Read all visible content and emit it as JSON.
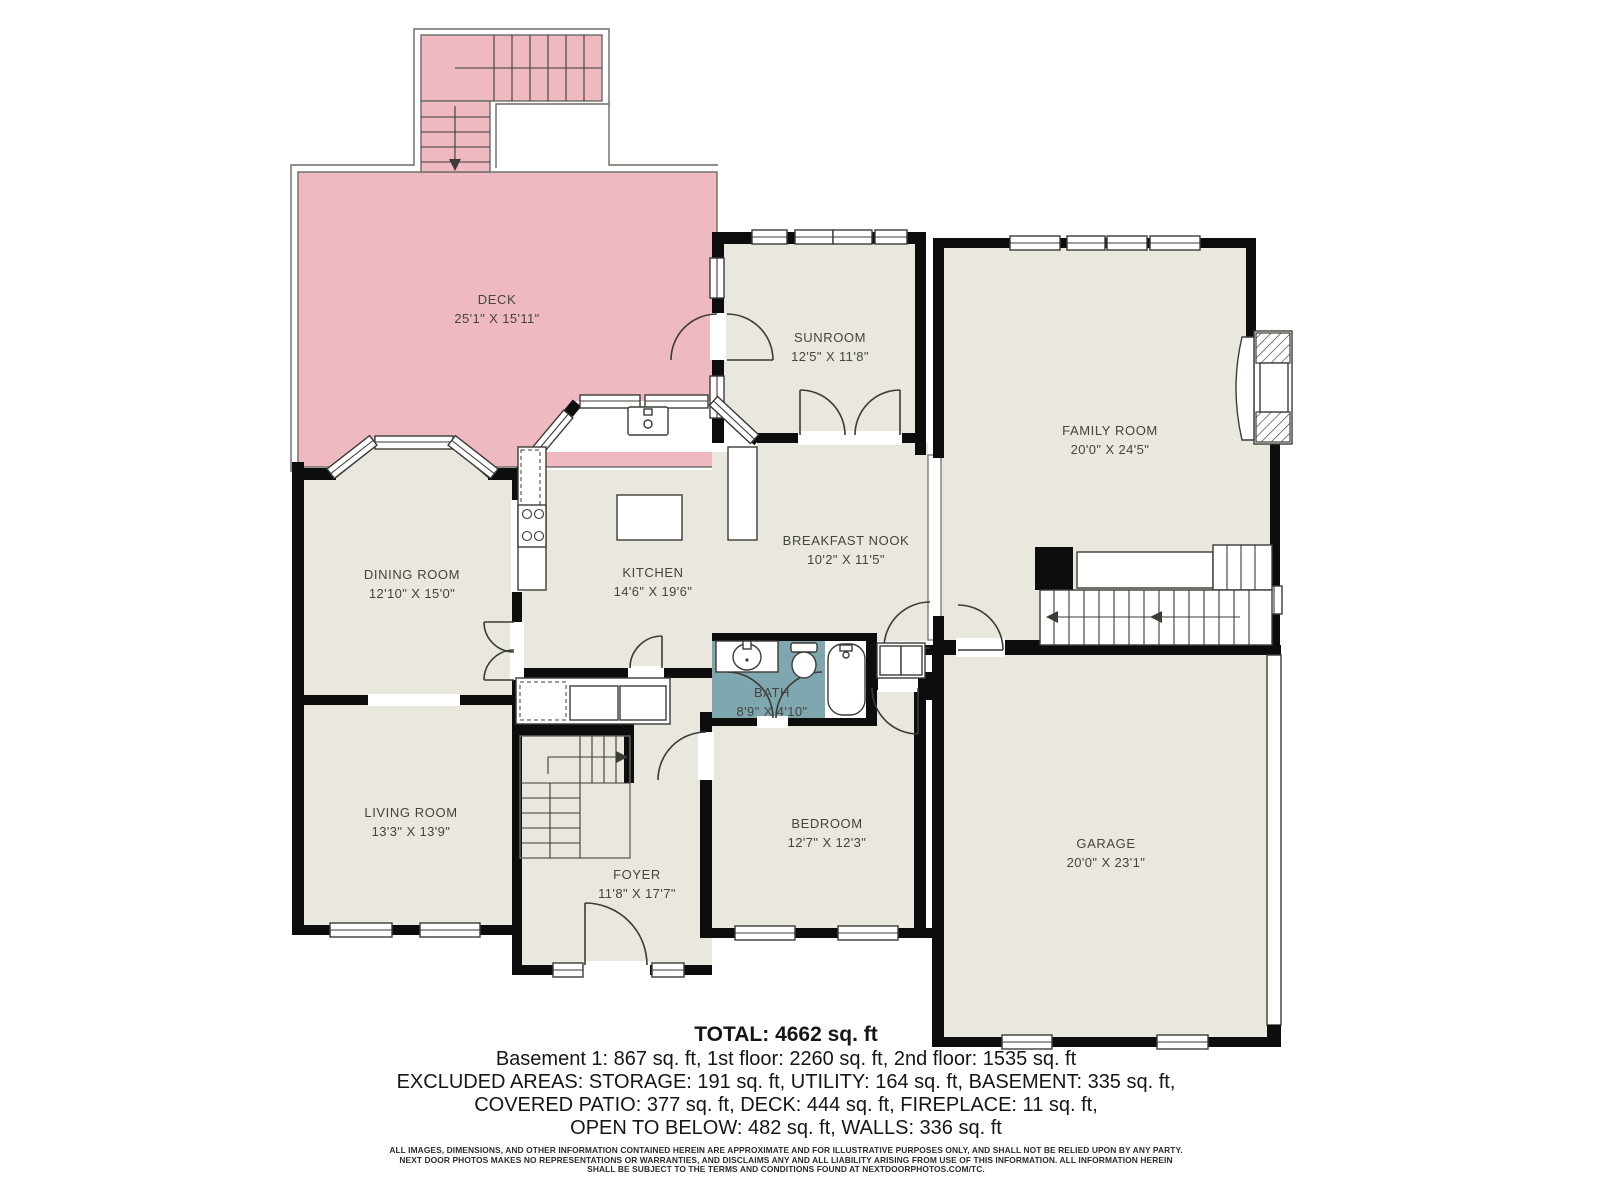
{
  "floor_plan": {
    "rooms": [
      {
        "name": "DECK",
        "dims": "25'1\" X 15'11\""
      },
      {
        "name": "SUNROOM",
        "dims": "12'5\" X 11'8\""
      },
      {
        "name": "FAMILY ROOM",
        "dims": "20'0\" X 24'5\""
      },
      {
        "name": "DINING ROOM",
        "dims": "12'10\" X 15'0\""
      },
      {
        "name": "KITCHEN",
        "dims": "14'6\" X 19'6\""
      },
      {
        "name": "BREAKFAST NOOK",
        "dims": "10'2\" X 11'5\""
      },
      {
        "name": "BATH",
        "dims": "8'9\" X 4'10\""
      },
      {
        "name": "LIVING ROOM",
        "dims": "13'3\" X 13'9\""
      },
      {
        "name": "BEDROOM",
        "dims": "12'7\" X 12'3\""
      },
      {
        "name": "FOYER",
        "dims": "11'8\" X 17'7\""
      },
      {
        "name": "GARAGE",
        "dims": "20'0\" X 23'1\""
      }
    ],
    "summary": {
      "total": "TOTAL: 4662 sq. ft",
      "floors": "Basement 1: 867 sq. ft, 1st floor: 2260 sq. ft, 2nd floor: 1535 sq. ft",
      "excluded1": "EXCLUDED AREAS: STORAGE: 191 sq. ft, UTILITY: 164 sq. ft, BASEMENT: 335 sq. ft,",
      "excluded2": "COVERED PATIO: 377 sq. ft, DECK: 444 sq. ft, FIREPLACE: 11 sq. ft,",
      "excluded3": "OPEN TO BELOW: 482 sq. ft, WALLS: 336 sq. ft"
    },
    "disclaimer": [
      "ALL IMAGES, DIMENSIONS, AND OTHER INFORMATION CONTAINED HEREIN ARE APPROXIMATE AND FOR ILLUSTRATIVE PURPOSES ONLY, AND SHALL NOT BE RELIED UPON BY ANY PARTY.",
      "NEXT DOOR PHOTOS MAKES NO REPRESENTATIONS OR WARRANTIES, AND DISCLAIMS ANY AND ALL LIABILITY ARISING FROM USE OF THIS INFORMATION. ALL INFORMATION HEREIN",
      "SHALL BE SUBJECT TO THE TERMS AND CONDITIONS FOUND AT NEXTDOORPHOTOS.COM/TC."
    ],
    "colors": {
      "deck": "#efb9c1",
      "bath": "#7fa7af",
      "floor": "#e9e7de",
      "wall": "#0d0d0d"
    }
  }
}
